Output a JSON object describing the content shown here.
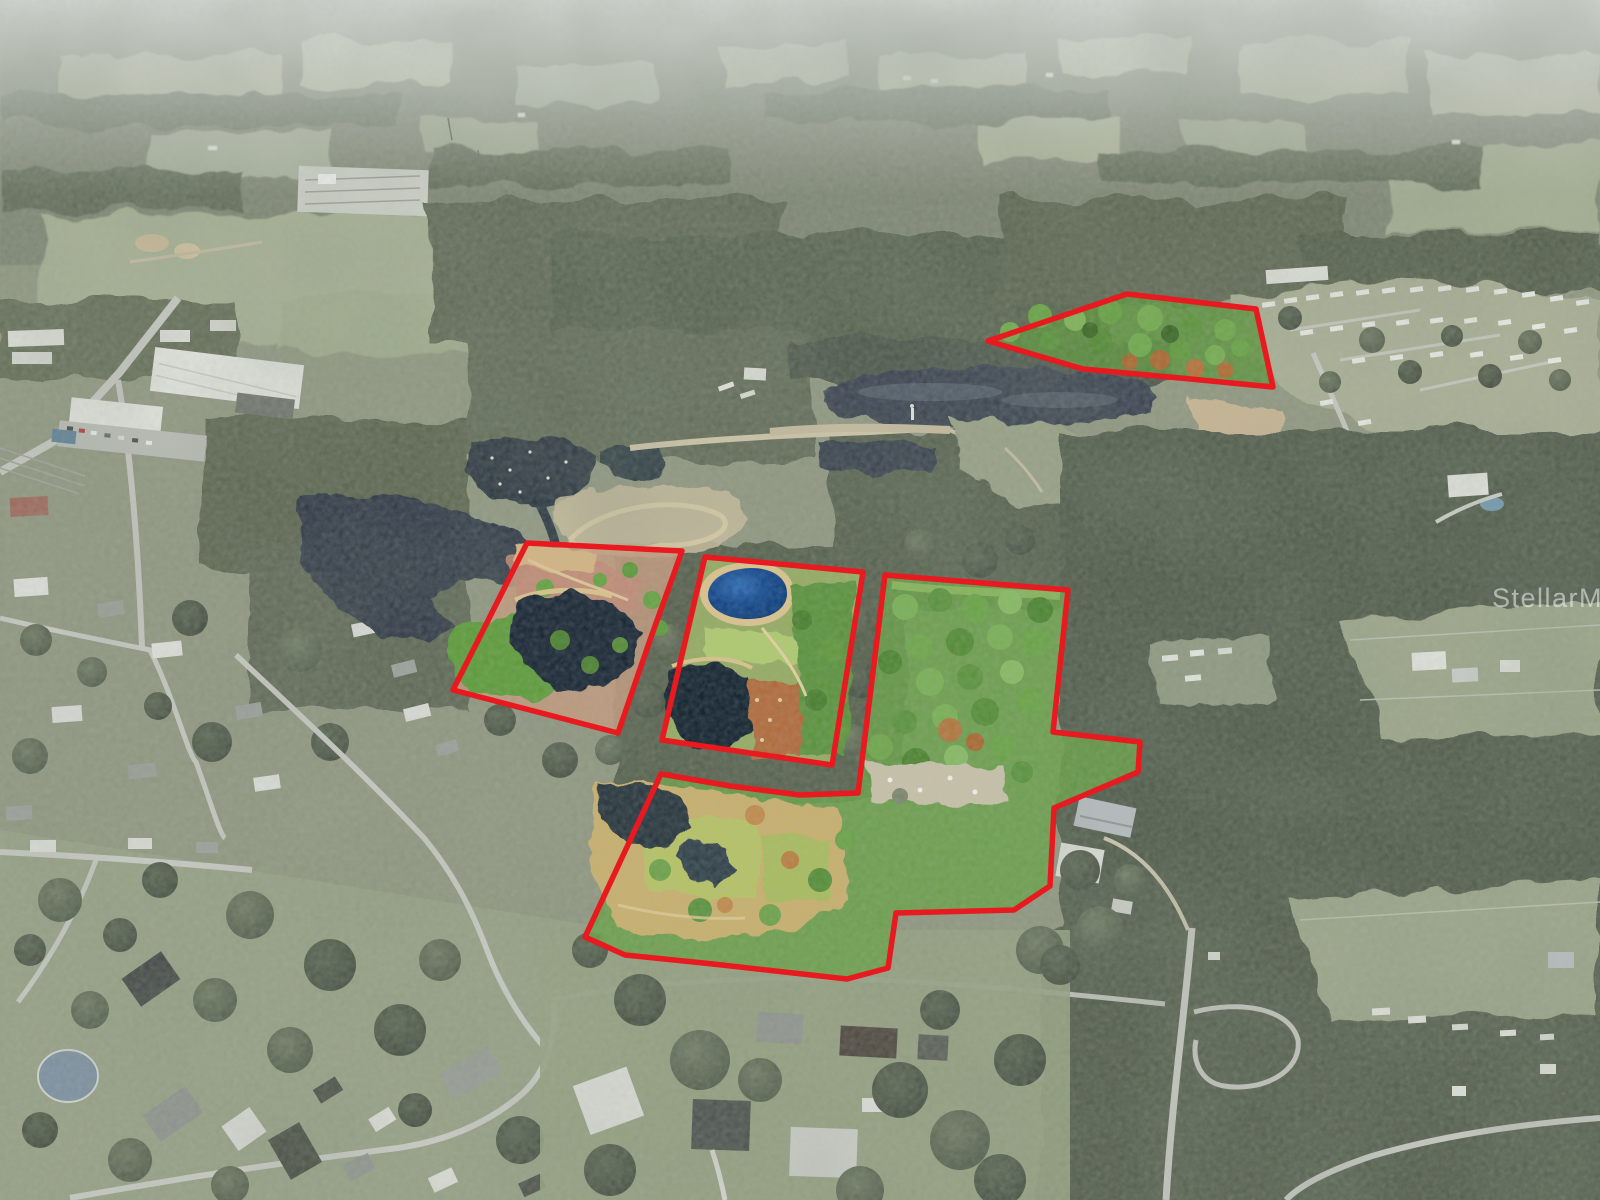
{
  "watermark": {
    "text": "StellarMLS",
    "color": "#ffffff",
    "opacity": 0.5
  },
  "annotation": {
    "outline_color": "#e8191f",
    "outline_width": 5.5,
    "parcels": [
      {
        "id": "north-parcel",
        "tint": "#5e9340",
        "tint_opacity": 0.85,
        "points": [
          [
            988,
            341
          ],
          [
            1127,
            294
          ],
          [
            1256,
            309
          ],
          [
            1273,
            387
          ],
          [
            1180,
            378
          ],
          [
            1083,
            369
          ]
        ]
      },
      {
        "id": "west-parcel",
        "tint": "#c29a7e",
        "tint_opacity": 0.85,
        "points": [
          [
            527,
            543
          ],
          [
            682,
            551
          ],
          [
            650,
            640
          ],
          [
            618,
            733
          ],
          [
            453,
            690
          ]
        ]
      },
      {
        "id": "center-parcel",
        "tint": "#a3bd68",
        "tint_opacity": 0.8,
        "points": [
          [
            705,
            557
          ],
          [
            863,
            572
          ],
          [
            832,
            765
          ],
          [
            662,
            740
          ]
        ]
      },
      {
        "id": "southeast-parcel",
        "tint": "#68a049",
        "tint_opacity": 0.85,
        "points": [
          [
            661,
            774
          ],
          [
            730,
            786
          ],
          [
            800,
            795
          ],
          [
            858,
            793
          ],
          [
            885,
            575
          ],
          [
            1068,
            590
          ],
          [
            1053,
            732
          ],
          [
            1140,
            742
          ],
          [
            1138,
            772
          ],
          [
            1054,
            808
          ],
          [
            1050,
            886
          ],
          [
            1014,
            910
          ],
          [
            896,
            913
          ],
          [
            888,
            968
          ],
          [
            847,
            979
          ],
          [
            713,
            964
          ],
          [
            625,
            955
          ],
          [
            585,
            937
          ]
        ]
      }
    ]
  }
}
